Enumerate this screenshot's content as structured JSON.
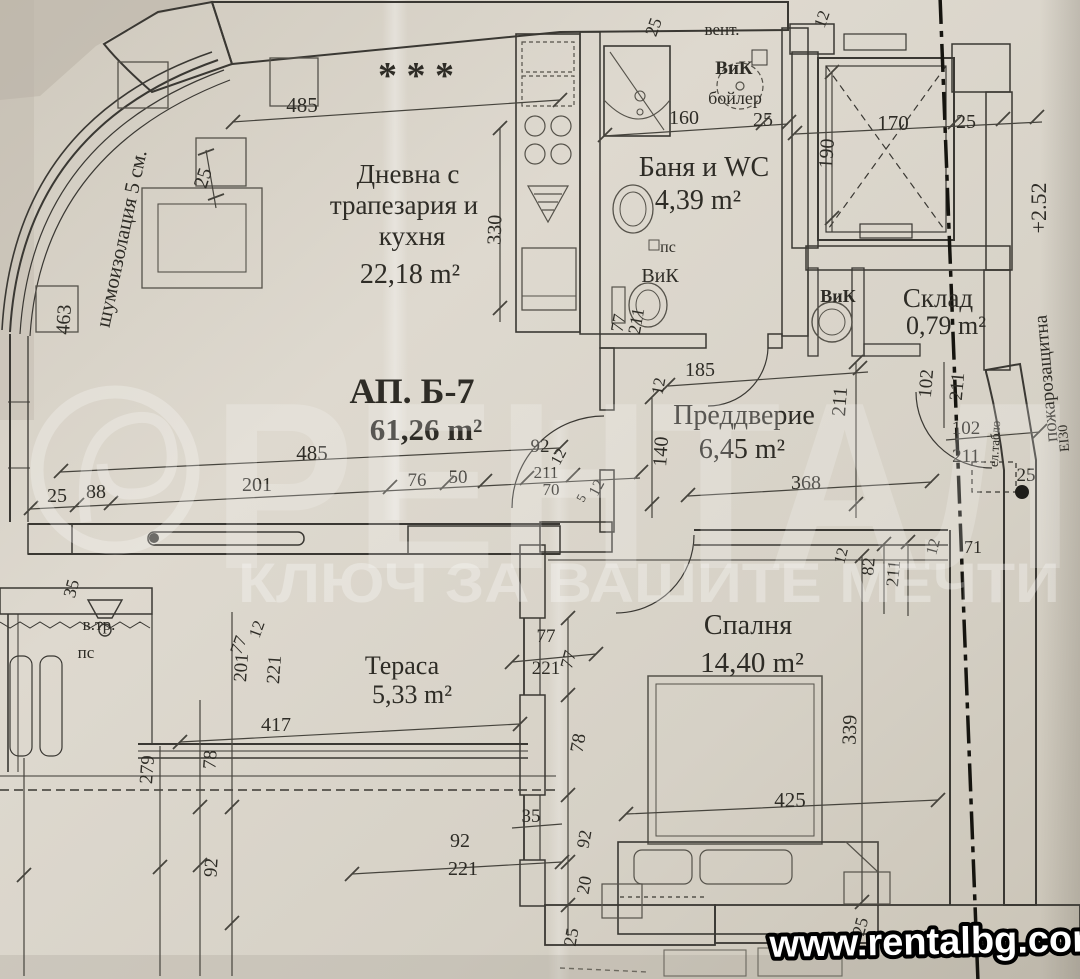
{
  "apartment": {
    "label": "АП. Б-7",
    "area": "61,26 m²"
  },
  "rooms": [
    {
      "name": "Дневна с трапезария и кухня",
      "area": "22,18 m²"
    },
    {
      "name": "Баня и WC",
      "area": "4,39 m²"
    },
    {
      "name": "Склад",
      "area": "0,79 m²"
    },
    {
      "name": "Преддверие",
      "area": "6,45 m²"
    },
    {
      "name": "Спалня",
      "area": "14,40 m²"
    },
    {
      "name": "Тераса",
      "area": "5,33 m²"
    }
  ],
  "watermark": {
    "brand": "РЕНТАЛ",
    "tagline": "КЛЮЧ ЗА ВАШИТЕ МЕЧТИ"
  },
  "footer": {
    "url": "www.rentalbg.com"
  },
  "annotations": {
    "insulation": "шумоизолация 5 см.",
    "vent": "вент.",
    "plumbing": "ВиК",
    "boiler": "бойлер",
    "fire_wall": "пожарозащитна",
    "fire_rating": "ЕІ30",
    "electric_panel": "ел.табло",
    "level_mark": "+2.52",
    "duct": "в.тр.",
    "ps": "пс"
  },
  "labels": [
    {
      "t": "Дневна с",
      "x": 408,
      "y": 183,
      "s": 27
    },
    {
      "t": "трапезария и",
      "x": 404,
      "y": 214,
      "s": 27
    },
    {
      "t": "кухня",
      "x": 412,
      "y": 245,
      "s": 27
    },
    {
      "t": "22,18 m²",
      "x": 410,
      "y": 283,
      "s": 28
    },
    {
      "t": "Баня и WC",
      "x": 704,
      "y": 176,
      "s": 28
    },
    {
      "t": "4,39 m²",
      "x": 698,
      "y": 209,
      "s": 28
    },
    {
      "t": "Склад",
      "x": 938,
      "y": 307,
      "s": 27
    },
    {
      "t": "0,79 m²",
      "x": 946,
      "y": 334,
      "s": 26
    },
    {
      "t": "Преддверие",
      "x": 744,
      "y": 424,
      "s": 28
    },
    {
      "t": "6,45 m²",
      "x": 742,
      "y": 458,
      "s": 28
    },
    {
      "t": "Спалня",
      "x": 748,
      "y": 634,
      "s": 28
    },
    {
      "t": "14,40 m²",
      "x": 752,
      "y": 672,
      "s": 29
    },
    {
      "t": "Тераса",
      "x": 402,
      "y": 674,
      "s": 26
    },
    {
      "t": "5,33 m²",
      "x": 412,
      "y": 703,
      "s": 26
    },
    {
      "t": "АП. Б-7",
      "x": 412,
      "y": 403,
      "s": 36,
      "b": 1
    },
    {
      "t": "61,26 m²",
      "x": 426,
      "y": 440,
      "s": 31,
      "b": 1
    },
    {
      "t": "* * *",
      "x": 416,
      "y": 88,
      "s": 38,
      "b": 1
    },
    {
      "t": "шумоизолация 5 см.",
      "x": 128,
      "y": 240,
      "s": 21,
      "r": -78
    },
    {
      "t": "вент.",
      "x": 722,
      "y": 35,
      "s": 17
    },
    {
      "t": "ВиК",
      "x": 734,
      "y": 74,
      "s": 19,
      "b": 1
    },
    {
      "t": "бойлер",
      "x": 735,
      "y": 104,
      "s": 18
    },
    {
      "t": "пс",
      "x": 668,
      "y": 252,
      "s": 16
    },
    {
      "t": "ВиК",
      "x": 660,
      "y": 282,
      "s": 20
    },
    {
      "t": "ВиК",
      "x": 838,
      "y": 302,
      "s": 18,
      "b": 1
    },
    {
      "t": "в.тр.",
      "x": 99,
      "y": 630,
      "s": 17
    },
    {
      "t": "пс",
      "x": 86,
      "y": 658,
      "s": 17
    },
    {
      "t": "пожарозащитна",
      "x": 1052,
      "y": 378,
      "s": 19,
      "r": -95
    },
    {
      "t": "ЕІ30",
      "x": 1068,
      "y": 438,
      "s": 14,
      "r": -95
    },
    {
      "t": "ел.табло",
      "x": 999,
      "y": 444,
      "s": 13,
      "r": -87
    },
    {
      "t": "+2.52",
      "x": 1046,
      "y": 208,
      "s": 22,
      "r": -90
    },
    {
      "t": "25",
      "x": 209,
      "y": 180,
      "s": 20,
      "r": -72
    },
    {
      "t": "485",
      "x": 302,
      "y": 112,
      "s": 21
    },
    {
      "t": "463",
      "x": 70,
      "y": 320,
      "s": 20,
      "r": -86
    },
    {
      "t": "330",
      "x": 501,
      "y": 230,
      "s": 20,
      "r": -88
    },
    {
      "t": "160",
      "x": 684,
      "y": 124,
      "s": 20
    },
    {
      "t": "25",
      "x": 763,
      "y": 126,
      "s": 20
    },
    {
      "t": "25",
      "x": 659,
      "y": 29,
      "s": 18,
      "r": -70
    },
    {
      "t": "12",
      "x": 827,
      "y": 21,
      "s": 17,
      "r": -70
    },
    {
      "t": "170",
      "x": 893,
      "y": 130,
      "s": 21
    },
    {
      "t": "190",
      "x": 833,
      "y": 154,
      "s": 20,
      "r": -86
    },
    {
      "t": "25",
      "x": 966,
      "y": 128,
      "s": 20
    },
    {
      "t": "485",
      "x": 312,
      "y": 460,
      "s": 21
    },
    {
      "t": "25",
      "x": 57,
      "y": 502,
      "s": 20
    },
    {
      "t": "88",
      "x": 96,
      "y": 498,
      "s": 20
    },
    {
      "t": "201",
      "x": 257,
      "y": 491,
      "s": 20
    },
    {
      "t": "76",
      "x": 417,
      "y": 486,
      "s": 19
    },
    {
      "t": "50",
      "x": 458,
      "y": 483,
      "s": 19
    },
    {
      "t": "92",
      "x": 540,
      "y": 452,
      "s": 19
    },
    {
      "t": "12",
      "x": 563,
      "y": 459,
      "s": 16,
      "r": -62
    },
    {
      "t": "211",
      "x": 546,
      "y": 478,
      "s": 17
    },
    {
      "t": "70",
      "x": 551,
      "y": 495,
      "s": 17
    },
    {
      "t": "12",
      "x": 601,
      "y": 490,
      "s": 16,
      "r": -62
    },
    {
      "t": "5",
      "x": 585,
      "y": 500,
      "s": 13,
      "r": -62
    },
    {
      "t": "185",
      "x": 700,
      "y": 376,
      "s": 20
    },
    {
      "t": "12",
      "x": 664,
      "y": 387,
      "s": 17,
      "r": -80
    },
    {
      "t": "140",
      "x": 667,
      "y": 452,
      "s": 20,
      "r": -86
    },
    {
      "t": "211",
      "x": 846,
      "y": 402,
      "s": 20,
      "r": -86
    },
    {
      "t": "368",
      "x": 806,
      "y": 489,
      "s": 20
    },
    {
      "t": "77",
      "x": 624,
      "y": 324,
      "s": 18,
      "r": -80
    },
    {
      "t": "211",
      "x": 642,
      "y": 322,
      "s": 18,
      "r": -80
    },
    {
      "t": "102",
      "x": 932,
      "y": 384,
      "s": 19,
      "r": -85
    },
    {
      "t": "211",
      "x": 963,
      "y": 387,
      "s": 19,
      "r": -85
    },
    {
      "t": "102",
      "x": 966,
      "y": 434,
      "s": 19
    },
    {
      "t": "211",
      "x": 966,
      "y": 462,
      "s": 19
    },
    {
      "t": "25",
      "x": 1026,
      "y": 481,
      "s": 19
    },
    {
      "t": "12",
      "x": 938,
      "y": 548,
      "s": 16,
      "r": -75
    },
    {
      "t": "82",
      "x": 874,
      "y": 567,
      "s": 18,
      "r": -85
    },
    {
      "t": "211",
      "x": 899,
      "y": 574,
      "s": 18,
      "r": -85
    },
    {
      "t": "12",
      "x": 846,
      "y": 557,
      "s": 16,
      "r": -75
    },
    {
      "t": "71",
      "x": 973,
      "y": 553,
      "s": 18
    },
    {
      "t": "339",
      "x": 856,
      "y": 730,
      "s": 20,
      "r": -88
    },
    {
      "t": "425",
      "x": 790,
      "y": 807,
      "s": 21
    },
    {
      "t": "77",
      "x": 546,
      "y": 642,
      "s": 19
    },
    {
      "t": "221",
      "x": 546,
      "y": 674,
      "s": 19
    },
    {
      "t": "77",
      "x": 574,
      "y": 661,
      "s": 18,
      "r": -75
    },
    {
      "t": "78",
      "x": 584,
      "y": 744,
      "s": 19,
      "r": -80
    },
    {
      "t": "35",
      "x": 531,
      "y": 822,
      "s": 19
    },
    {
      "t": "92",
      "x": 590,
      "y": 840,
      "s": 18,
      "r": -80
    },
    {
      "t": "20",
      "x": 590,
      "y": 886,
      "s": 18,
      "r": -80
    },
    {
      "t": "92",
      "x": 460,
      "y": 847,
      "s": 20
    },
    {
      "t": "221",
      "x": 463,
      "y": 875,
      "s": 20
    },
    {
      "t": "25",
      "x": 866,
      "y": 928,
      "s": 18,
      "r": -75
    },
    {
      "t": "25",
      "x": 577,
      "y": 938,
      "s": 18,
      "r": -80
    },
    {
      "t": "12",
      "x": 262,
      "y": 631,
      "s": 17,
      "r": -70
    },
    {
      "t": "77",
      "x": 244,
      "y": 647,
      "s": 18,
      "r": -70
    },
    {
      "t": "201",
      "x": 247,
      "y": 668,
      "s": 19,
      "r": -86
    },
    {
      "t": "221",
      "x": 280,
      "y": 670,
      "s": 19,
      "r": -86
    },
    {
      "t": "417",
      "x": 276,
      "y": 731,
      "s": 20
    },
    {
      "t": "78",
      "x": 216,
      "y": 760,
      "s": 19,
      "r": -86
    },
    {
      "t": "279",
      "x": 153,
      "y": 770,
      "s": 19,
      "r": -86
    },
    {
      "t": "92",
      "x": 217,
      "y": 868,
      "s": 19,
      "r": -86
    },
    {
      "t": "35",
      "x": 77,
      "y": 590,
      "s": 18,
      "r": -75
    }
  ]
}
